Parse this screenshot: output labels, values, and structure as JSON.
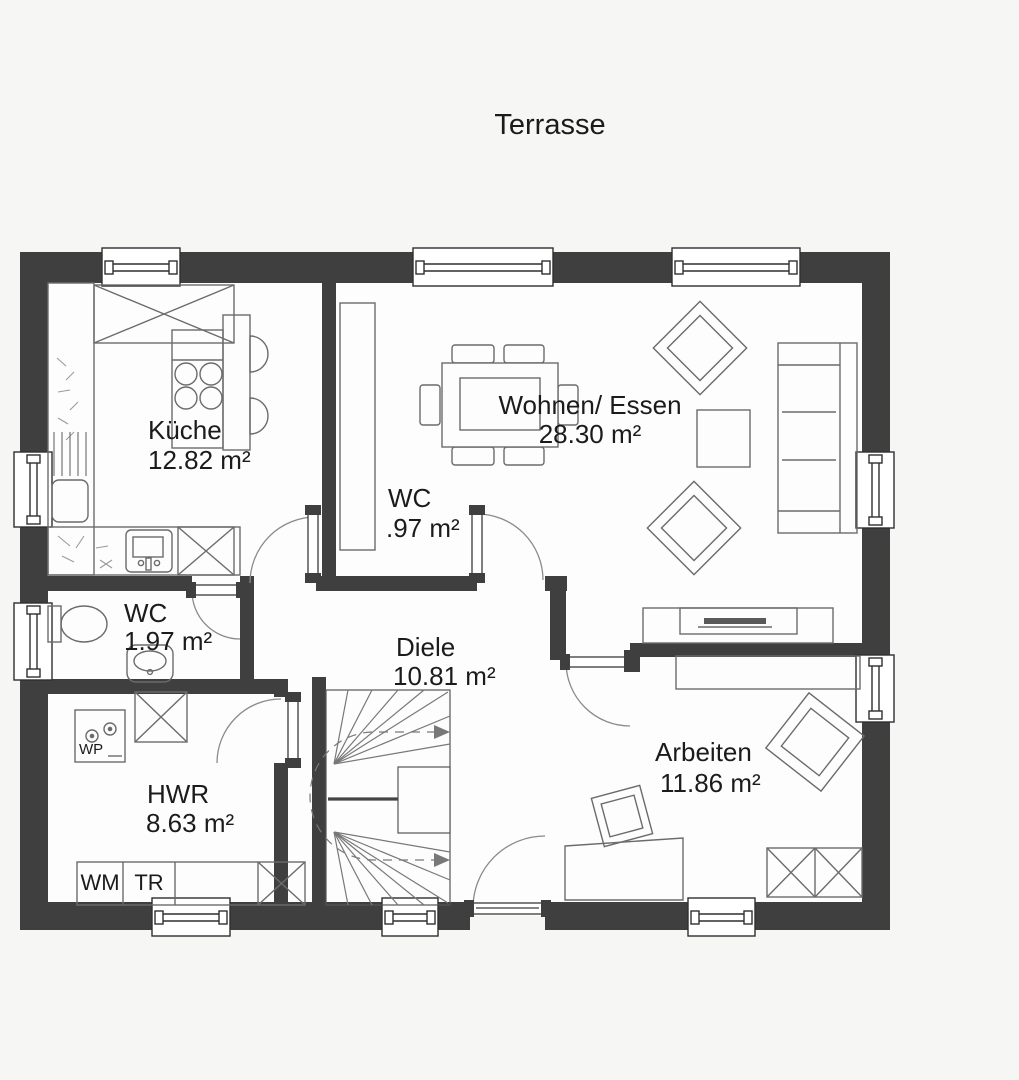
{
  "title": "Terrasse",
  "rooms": {
    "kueche": {
      "name": "Küche",
      "area": "12.82 m²"
    },
    "wohnen": {
      "name": "Wohnen/ Essen",
      "area": "28.30 m²"
    },
    "wc_klein": {
      "name": "WC",
      "area": ".97 m²"
    },
    "wc": {
      "name": "WC",
      "area": "1.97 m²"
    },
    "diele": {
      "name": "Diele",
      "area": "10.81 m²"
    },
    "hwr": {
      "name": "HWR",
      "area": "8.63 m²"
    },
    "arbeiten": {
      "name": "Arbeiten",
      "area": "11.86 m²"
    }
  },
  "appliances": {
    "wm": "WM",
    "tr": "TR",
    "wp": "WP"
  },
  "colors": {
    "wall": "#3f3f3f",
    "furniture_line": "#6b6b6b",
    "background": "#f6f6f5",
    "floor": "#fdfdfd",
    "text": "#1b1b1b"
  }
}
